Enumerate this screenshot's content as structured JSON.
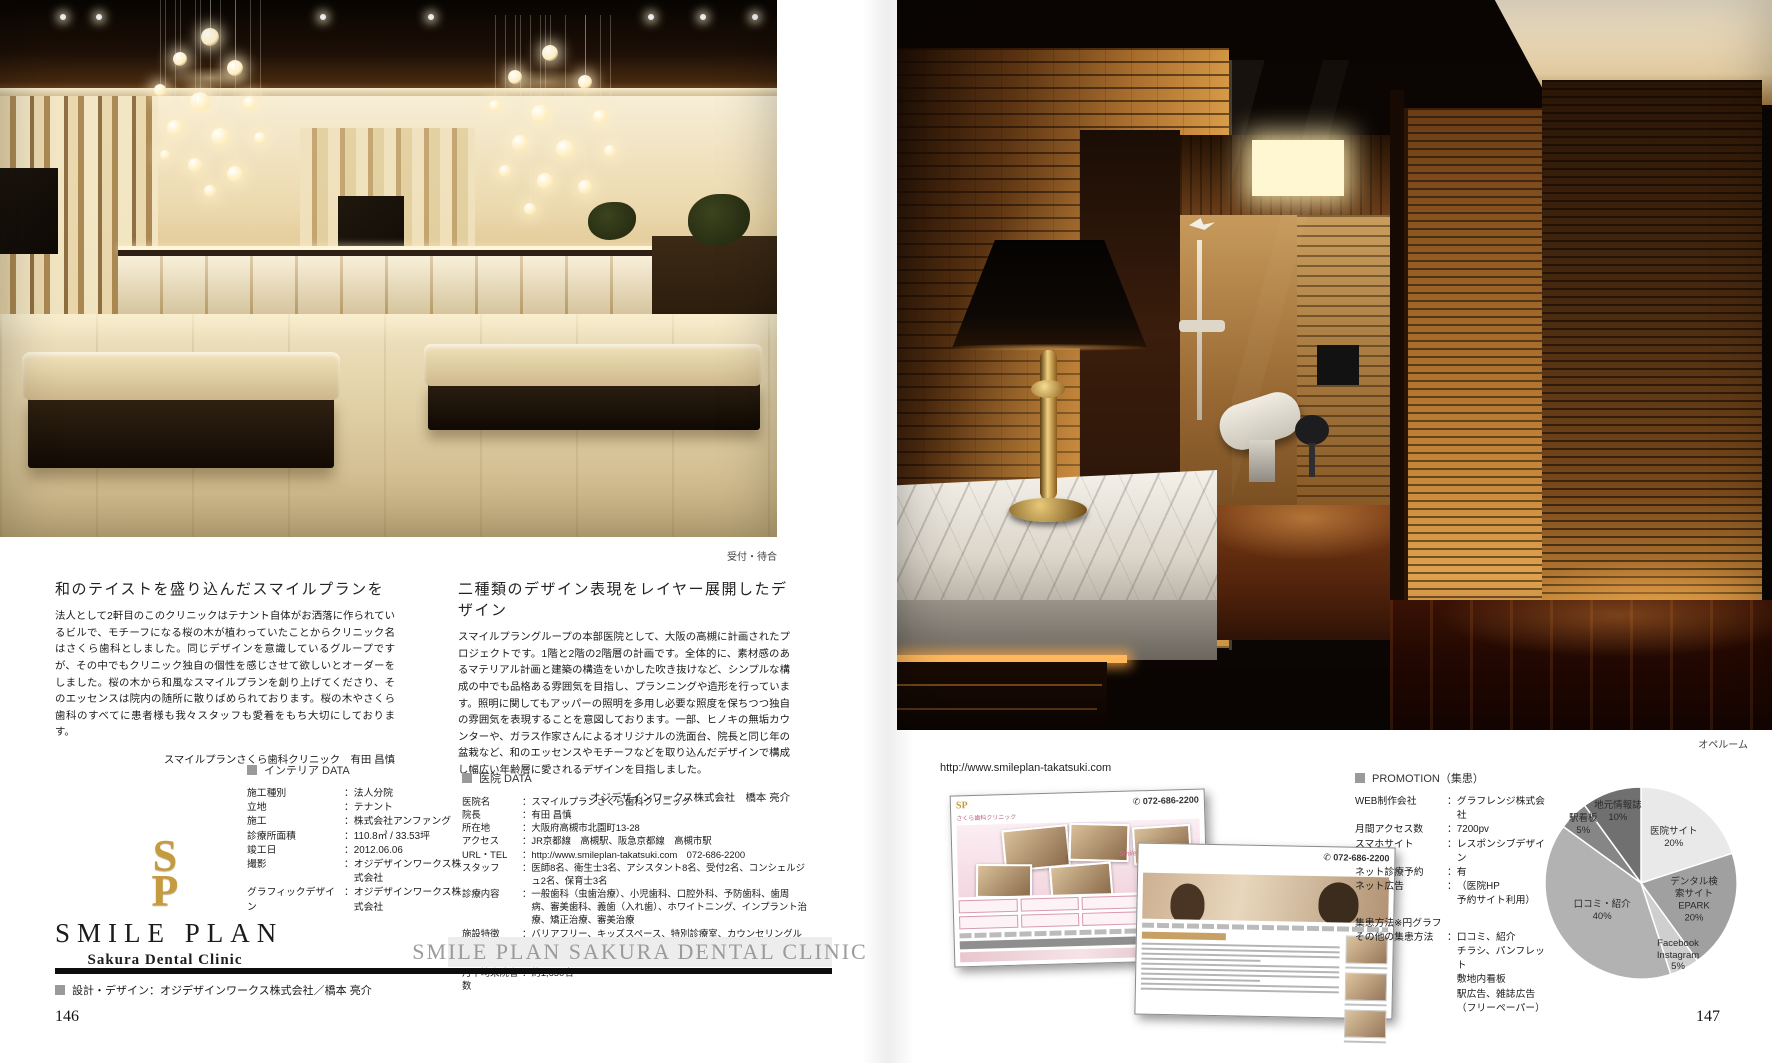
{
  "page": {
    "left_page_number": "146",
    "right_page_number": "147"
  },
  "photos": {
    "left_caption": "受付・待合",
    "right_caption": "オペルーム"
  },
  "left_article": {
    "heading": "和のテイストを盛り込んだスマイルプランを",
    "body": "法人として2軒目のこのクリニックはテナント自体がお洒落に作られているビルで、モチーフになる桜の木が植わっていたことからクリニック名はさくら歯科としました。同じデザインを意識しているグループですが、その中でもクリニック独自の個性を感じさせて欲しいとオーダーをしました。桜の木から和風なスマイルプランを創り上げてくださり、そのエッセンスは院内の随所に散りばめられております。桜の木やさくら歯科のすべてに患者様も我々スタッフも愛着をもち大切にしております。",
    "attribution": "スマイルプランさくら歯科クリニック　有田 昌慎"
  },
  "right_article": {
    "heading": "二種類のデザイン表現をレイヤー展開したデザイン",
    "body": "スマイルプラングループの本部医院として、大阪の高槻に計画されたプロジェクトです。1階と2階の2階層の計画です。全体的に、素材感のあるマテリアル計画と建築の構造をいかした吹き抜けなど、シンプルな構成の中でも品格ある雰囲気を目指し、プランニングや造形を行っています。照明に関してもアッパーの照明を多用し必要な照度を保ちつつ独自の雰囲気を表現することを意図しております。一部、ヒノキの無垢カウンターや、ガラス作家さんによるオリジナルの洗面台、院長と同じ年の盆栽など、和のエッセンスやモチーフなどを取り込んだデザインで構成し幅広い年齢層に愛されるデザインを目指しました。",
    "attribution": "オジデザインワークス株式会社　橋本 亮介"
  },
  "interior_data": {
    "title": "インテリア DATA",
    "rows": [
      {
        "label": "施工種別",
        "value": "法人分院"
      },
      {
        "label": "立地",
        "value": "テナント"
      },
      {
        "label": "施工",
        "value": "株式会社アンファング"
      },
      {
        "label": "診療所面積",
        "value": "110.8㎡ / 33.53坪"
      },
      {
        "label": "竣工日",
        "value": "2012.06.06"
      },
      {
        "label": "撮影",
        "value": "オジデザインワークス株式会社"
      },
      {
        "label": "グラフィックデザイン",
        "value": "オジデザインワークス株式会社"
      }
    ]
  },
  "clinic_data": {
    "title": "医院 DATA",
    "rows": [
      {
        "label": "医院名",
        "value": "スマイルプランさくら歯科クリニック"
      },
      {
        "label": "院長",
        "value": "有田 昌慎"
      },
      {
        "label": "所在地",
        "value": "大阪府高槻市北園町13-28"
      },
      {
        "label": "アクセス",
        "value": "JR京都線　高槻駅、阪急京都線　高槻市駅"
      },
      {
        "label": "URL・TEL",
        "value": "http://www.smileplan-takatsuki.com　072-686-2200"
      },
      {
        "label": "スタッフ",
        "value": "医師8名、衛生士3名、アシスタント8名、受付2名、コンシェルジュ2名、保育士3名"
      },
      {
        "label": "診療内容",
        "value": "一般歯科（虫歯治療）、小児歯科、口腔外科、予防歯科、歯周病、審美歯科、義歯（入れ歯）、ホワイトニング、インプラント治療、矯正治療、審美治療"
      },
      {
        "label": "施設特徴",
        "value": "バリアフリー、キッズスペース、特別診療室、カウンセリングルーム、オペ室、CT-X線"
      },
      {
        "label": "診療室",
        "value": "8室"
      },
      {
        "label": "月平均来院者数",
        "value": "約1,650名"
      }
    ]
  },
  "logo": {
    "monogram": "SP",
    "name": "SMILE PLAN",
    "subname": "Sakura Dental Clinic",
    "banner": "SMILE PLAN SAKURA DENTAL CLINIC",
    "design_credit": "設計・デザイン：オジデザインワークス株式会社／橋本 亮介"
  },
  "website": {
    "url": "http://www.smileplan-takatsuki.com",
    "phone": "072-686-2200",
    "clinic_name": "さくら歯科クリニック",
    "tagline": "Smile Happening",
    "logo_monogram": "SP"
  },
  "promotion": {
    "title": "PROMOTION（集患）",
    "rows": [
      {
        "label": "WEB制作会社",
        "value": "グラフレンジ株式会社"
      },
      {
        "label": "月間アクセス数",
        "value": "7200pv"
      },
      {
        "label": "スマホサイト",
        "value": "レスポンシブデザイン"
      },
      {
        "label": "ネット診療予約",
        "value": "有"
      },
      {
        "label": "ネット広告",
        "value": "（医院HP\n予約サイト利用）"
      }
    ],
    "note": "集患方法※円グラフ",
    "other": {
      "label": "その他の集患方法",
      "value": "口コミ、紹介\nチラシ、パンフレット\n敷地内看板\n駅広告、雑誌広告\n（フリーペーパー）"
    }
  },
  "chart_data": {
    "type": "pie",
    "title": "集患方法",
    "labels": [
      "医院サイト",
      "デンタル検索サイト\nEPARK",
      "Facebook\nInstagram",
      "口コミ・紹介",
      "駅看板",
      "地元情報誌"
    ],
    "values": [
      20,
      20,
      5,
      40,
      5,
      10
    ],
    "unit": "%",
    "colors": [
      "#e9e9e9",
      "#a0a0a0",
      "#cfcfcf",
      "#b2b2b2",
      "#868686",
      "#707070"
    ],
    "start_angle": "12-oclock-clockwise",
    "stroke": "#ffffff"
  }
}
